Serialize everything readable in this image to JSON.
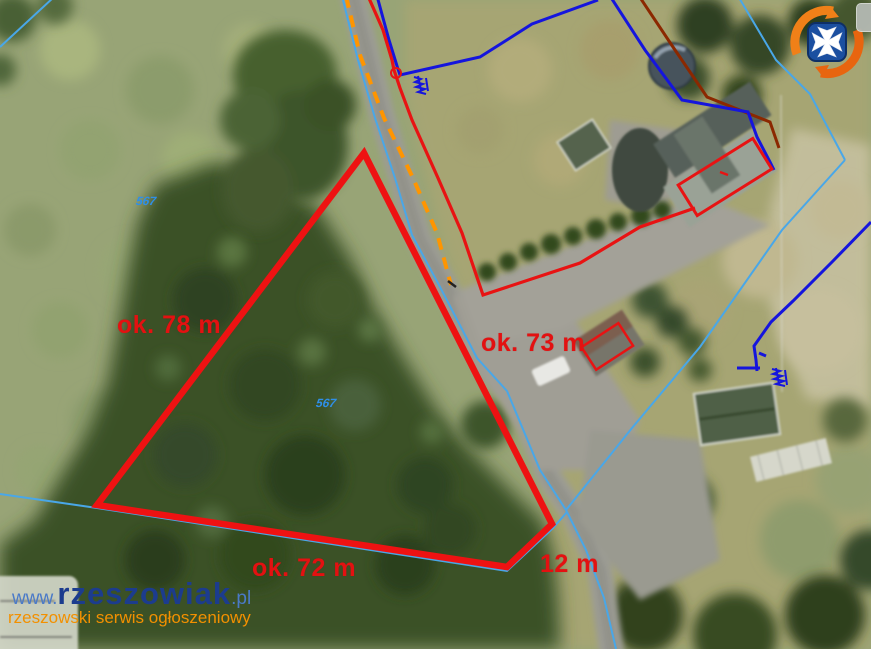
{
  "map": {
    "type": "aerial-photo-with-cadastral-overlay",
    "plot": {
      "outline_color": "#ee1212",
      "edges": [
        {
          "side": "west",
          "label": "ok. 78 m"
        },
        {
          "side": "road",
          "label": "ok. 73 m"
        },
        {
          "side": "south",
          "label": "ok. 72 m"
        },
        {
          "side": "southeast",
          "label": "12 m"
        }
      ]
    },
    "parcel_numbers": [
      {
        "value": "567"
      },
      {
        "value": "567"
      }
    ],
    "overlay_colors": {
      "plot_outline_red": "#ee1212",
      "neighbor_outline_red": "#e81313",
      "cadastral_boundary_cyan": "#49a7e8",
      "utility_line_blue": "#1515dd",
      "boundary_dark_red": "#8b2800",
      "road_axis_orange": "#ff9500",
      "measurement_text_red": "#e31111",
      "parcel_number_blue": "#2f8fe8"
    }
  },
  "watermark": {
    "prefix": "www.",
    "name": "rzeszowiak",
    "suffix": ".pl",
    "tagline": "rzeszowski serwis ogłoszeniowy",
    "name_color": "#1c3c8e",
    "tagline_color": "#f29000"
  },
  "branding": {
    "logo_name": "rzeszow-crest-logo",
    "logo_ring_color": "#f08018",
    "logo_shield_color": "#1b4fa0",
    "logo_cross_color": "#ffffff"
  },
  "icons": {
    "utility_symbol": "blue-scribble-annotation",
    "survey_point": "red-circle-marker"
  }
}
